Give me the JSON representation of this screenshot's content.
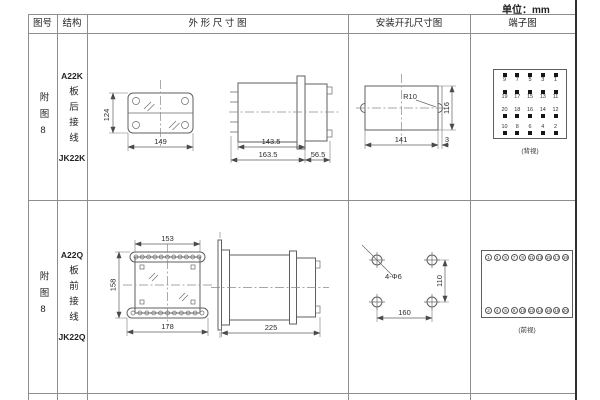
{
  "unit": "单位：mm",
  "header": {
    "col_figure": "图号",
    "col_structure": "结构",
    "col_outline": "外 形 尺 寸 图",
    "col_mounting": "安装开孔尺寸图",
    "col_terminal": "端子图"
  },
  "rows": [
    {
      "figure_no": "附图8",
      "model": "A22K",
      "wiring": "板后接线",
      "relay_model": "JK22K",
      "outline": {
        "height": "124",
        "width": "149",
        "len_inner": "143.5",
        "len_outer": "163.5",
        "depth": "56.5"
      },
      "mounting": {
        "radius": "R10",
        "width": "141",
        "edge": "3",
        "height": "116"
      },
      "terminal": {
        "grid": [
          [
            "9",
            "7",
            "5",
            "3",
            "1"
          ],
          [
            "19",
            "17",
            "15",
            "13",
            "11"
          ],
          [
            "20",
            "18",
            "16",
            "14",
            "12"
          ],
          [
            "10",
            "8",
            "6",
            "4",
            "2"
          ]
        ],
        "caption": "(背视)"
      }
    },
    {
      "figure_no": "附图8",
      "model": "A22Q",
      "wiring": "板前接线",
      "relay_model": "JK22Q",
      "outline": {
        "top_width": "153",
        "height": "158",
        "width": "178",
        "depth": "225"
      },
      "mounting": {
        "holes": "4-Φ6",
        "width": "160",
        "height": "110"
      },
      "terminal": {
        "top": [
          "1",
          "3",
          "5",
          "7",
          "9",
          "11",
          "13",
          "15",
          "17",
          "19"
        ],
        "bottom": [
          "2",
          "4",
          "6",
          "8",
          "10",
          "12",
          "14",
          "16",
          "18",
          "20"
        ],
        "caption": "(前视)"
      }
    }
  ]
}
